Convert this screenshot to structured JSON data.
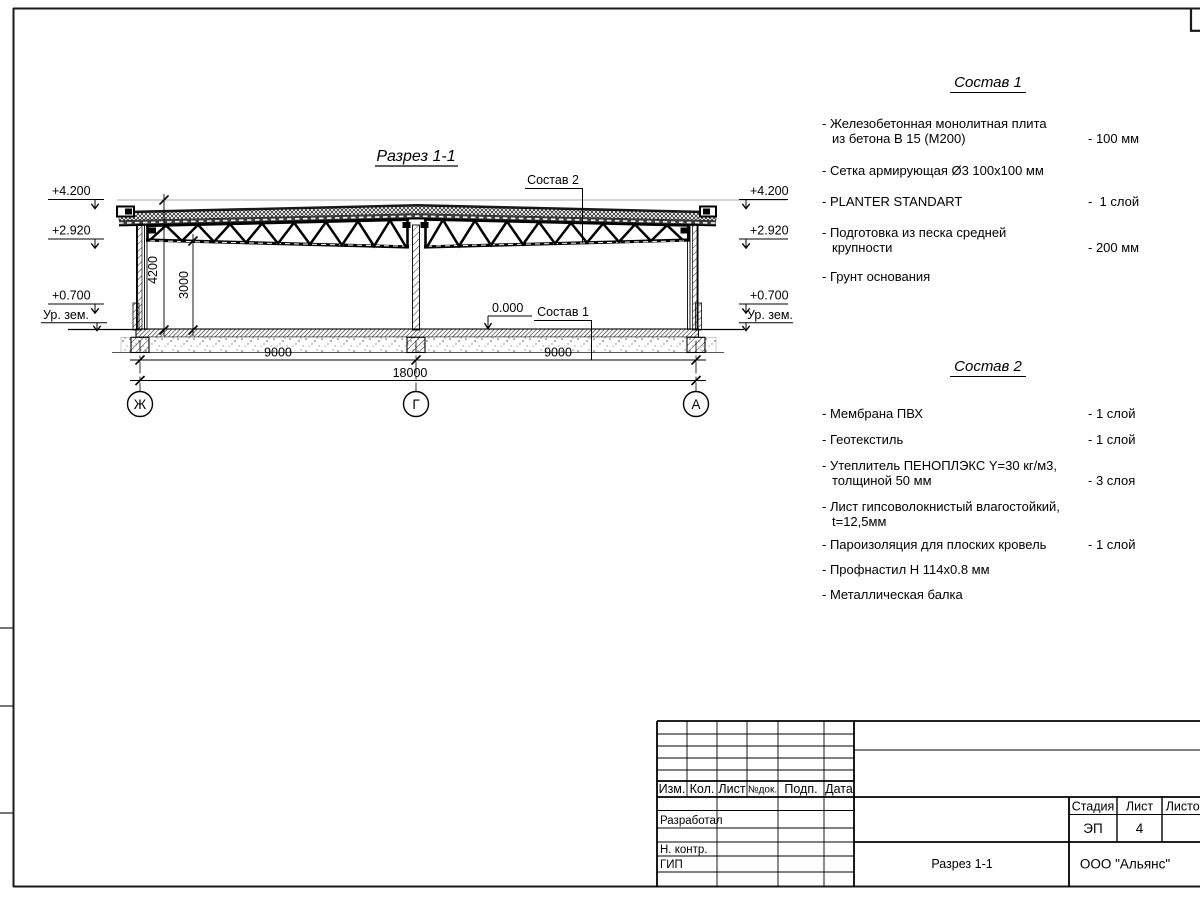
{
  "section": {
    "title": "Разрез 1-1",
    "callout_roof": "Состав 2",
    "callout_floor": "Состав 1",
    "zero_mark": "0.000",
    "elev_top": "+4.200",
    "elev_mid": "+2.920",
    "elev_low": "+0.700",
    "ground_label": "Ур. зем.",
    "dim_height_full": "4200",
    "dim_height_clear": "3000",
    "dim_span_left": "9000",
    "dim_span_right": "9000",
    "dim_span_total": "18000",
    "axis_left": "Ж",
    "axis_mid": "Г",
    "axis_right": "А"
  },
  "compositions": [
    {
      "title": "Состав 1",
      "items": [
        {
          "name": "- Железобетонная  монолитная плита\nиз бетона В 15 (М200)",
          "value": "- 100 мм"
        },
        {
          "name": "- Сетка армирующая Ø3 100x100 мм",
          "value": ""
        },
        {
          "name": "- PLANTER STANDART",
          "value": "-  1 слой"
        },
        {
          "name": "- Подготовка из песка средней\nкрупности",
          "value": "- 200 мм"
        },
        {
          "name": "- Грунт основания",
          "value": ""
        }
      ]
    },
    {
      "title": "Состав 2",
      "items": [
        {
          "name": "- Мембрана ПВХ",
          "value": "- 1 слой"
        },
        {
          "name": "- Геотекстиль",
          "value": "- 1 слой"
        },
        {
          "name": "- Утеплитель ПЕНОПЛЭКС Y=30 кг/м3,\nтолщиной 50 мм",
          "value": "- 3 слоя"
        },
        {
          "name": "- Лист гипсоволокнистый влагостойкий,\nt=12,5мм",
          "value": ""
        },
        {
          "name": "- Пароизоляция для плоских кровель",
          "value": "- 1 слой"
        },
        {
          "name": "- Профнастил Н 114x0.8 мм",
          "value": ""
        },
        {
          "name": "- Металлическая балка",
          "value": ""
        }
      ]
    }
  ],
  "titleblock": {
    "header": [
      "Изм.",
      "Кол.",
      "Лист",
      "№док.",
      "Подп.",
      "Дата"
    ],
    "roles": {
      "developer": "Разработал",
      "ncontrol": "Н. контр.",
      "gip": "ГИП"
    },
    "stage": {
      "label": "Стадия",
      "value": "ЭП"
    },
    "sheet": {
      "label": "Лист",
      "value": "4"
    },
    "sheets": {
      "label": "Листов",
      "value": ""
    },
    "doc_title": "Разрез 1-1",
    "company": "ООО \"Альянс\""
  }
}
